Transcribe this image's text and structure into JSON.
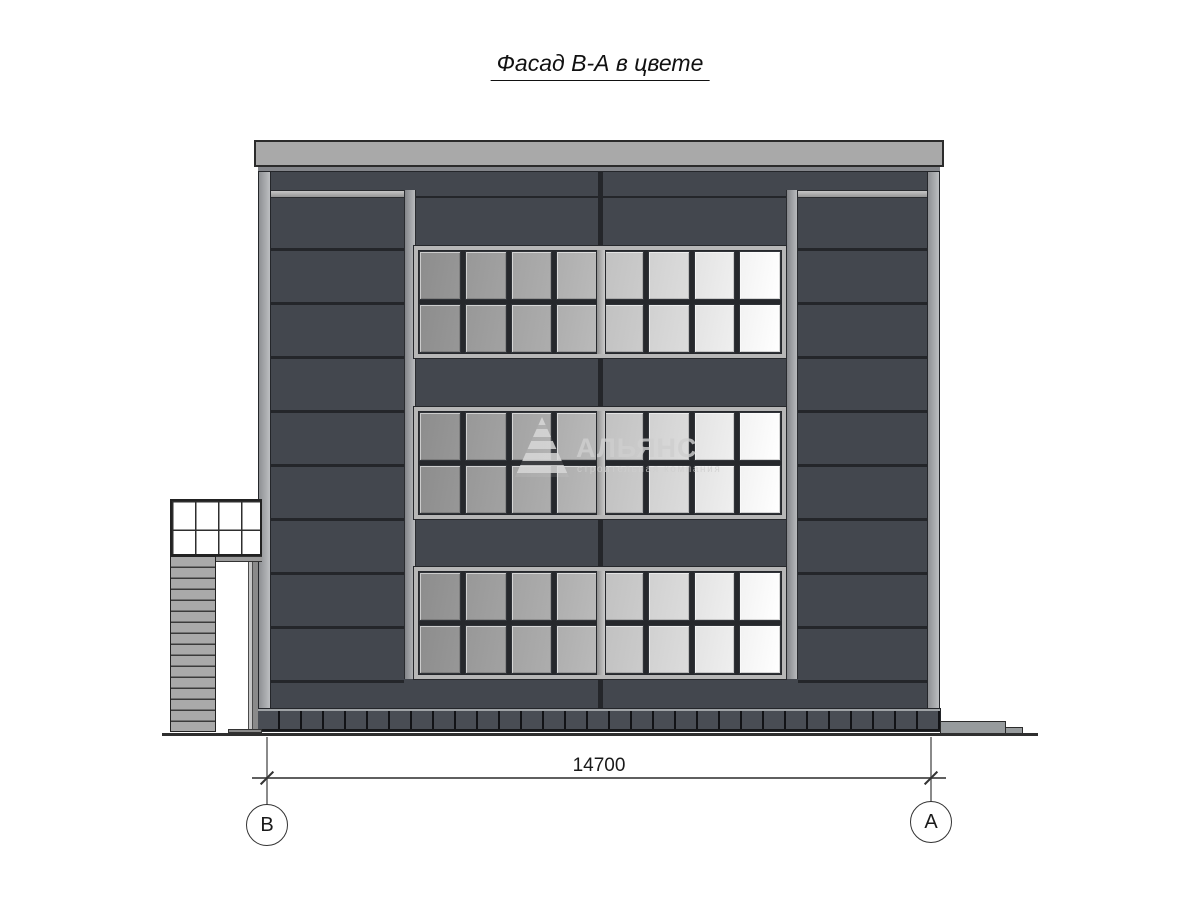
{
  "title": "Фасад В-А в цвете",
  "watermark": {
    "logo_icon": "stepped-pyramid-icon",
    "name": "АЛЬЯНС",
    "subtitle": "строительная компания"
  },
  "dimension": {
    "value": "14700"
  },
  "axes": [
    {
      "label": "В"
    },
    {
      "label": "А"
    }
  ],
  "colors": {
    "facade_dark": "#43474e",
    "panel_joint": "#24262a",
    "trim_light_gray": "#a9a9a9",
    "window_frame": "#b7b7b7",
    "glass_gradient_start": "#8d8d8d",
    "glass_gradient_end": "#ffffff",
    "plinth": "#494d54",
    "ground_line": "#2f2f2f",
    "background": "#ffffff"
  }
}
